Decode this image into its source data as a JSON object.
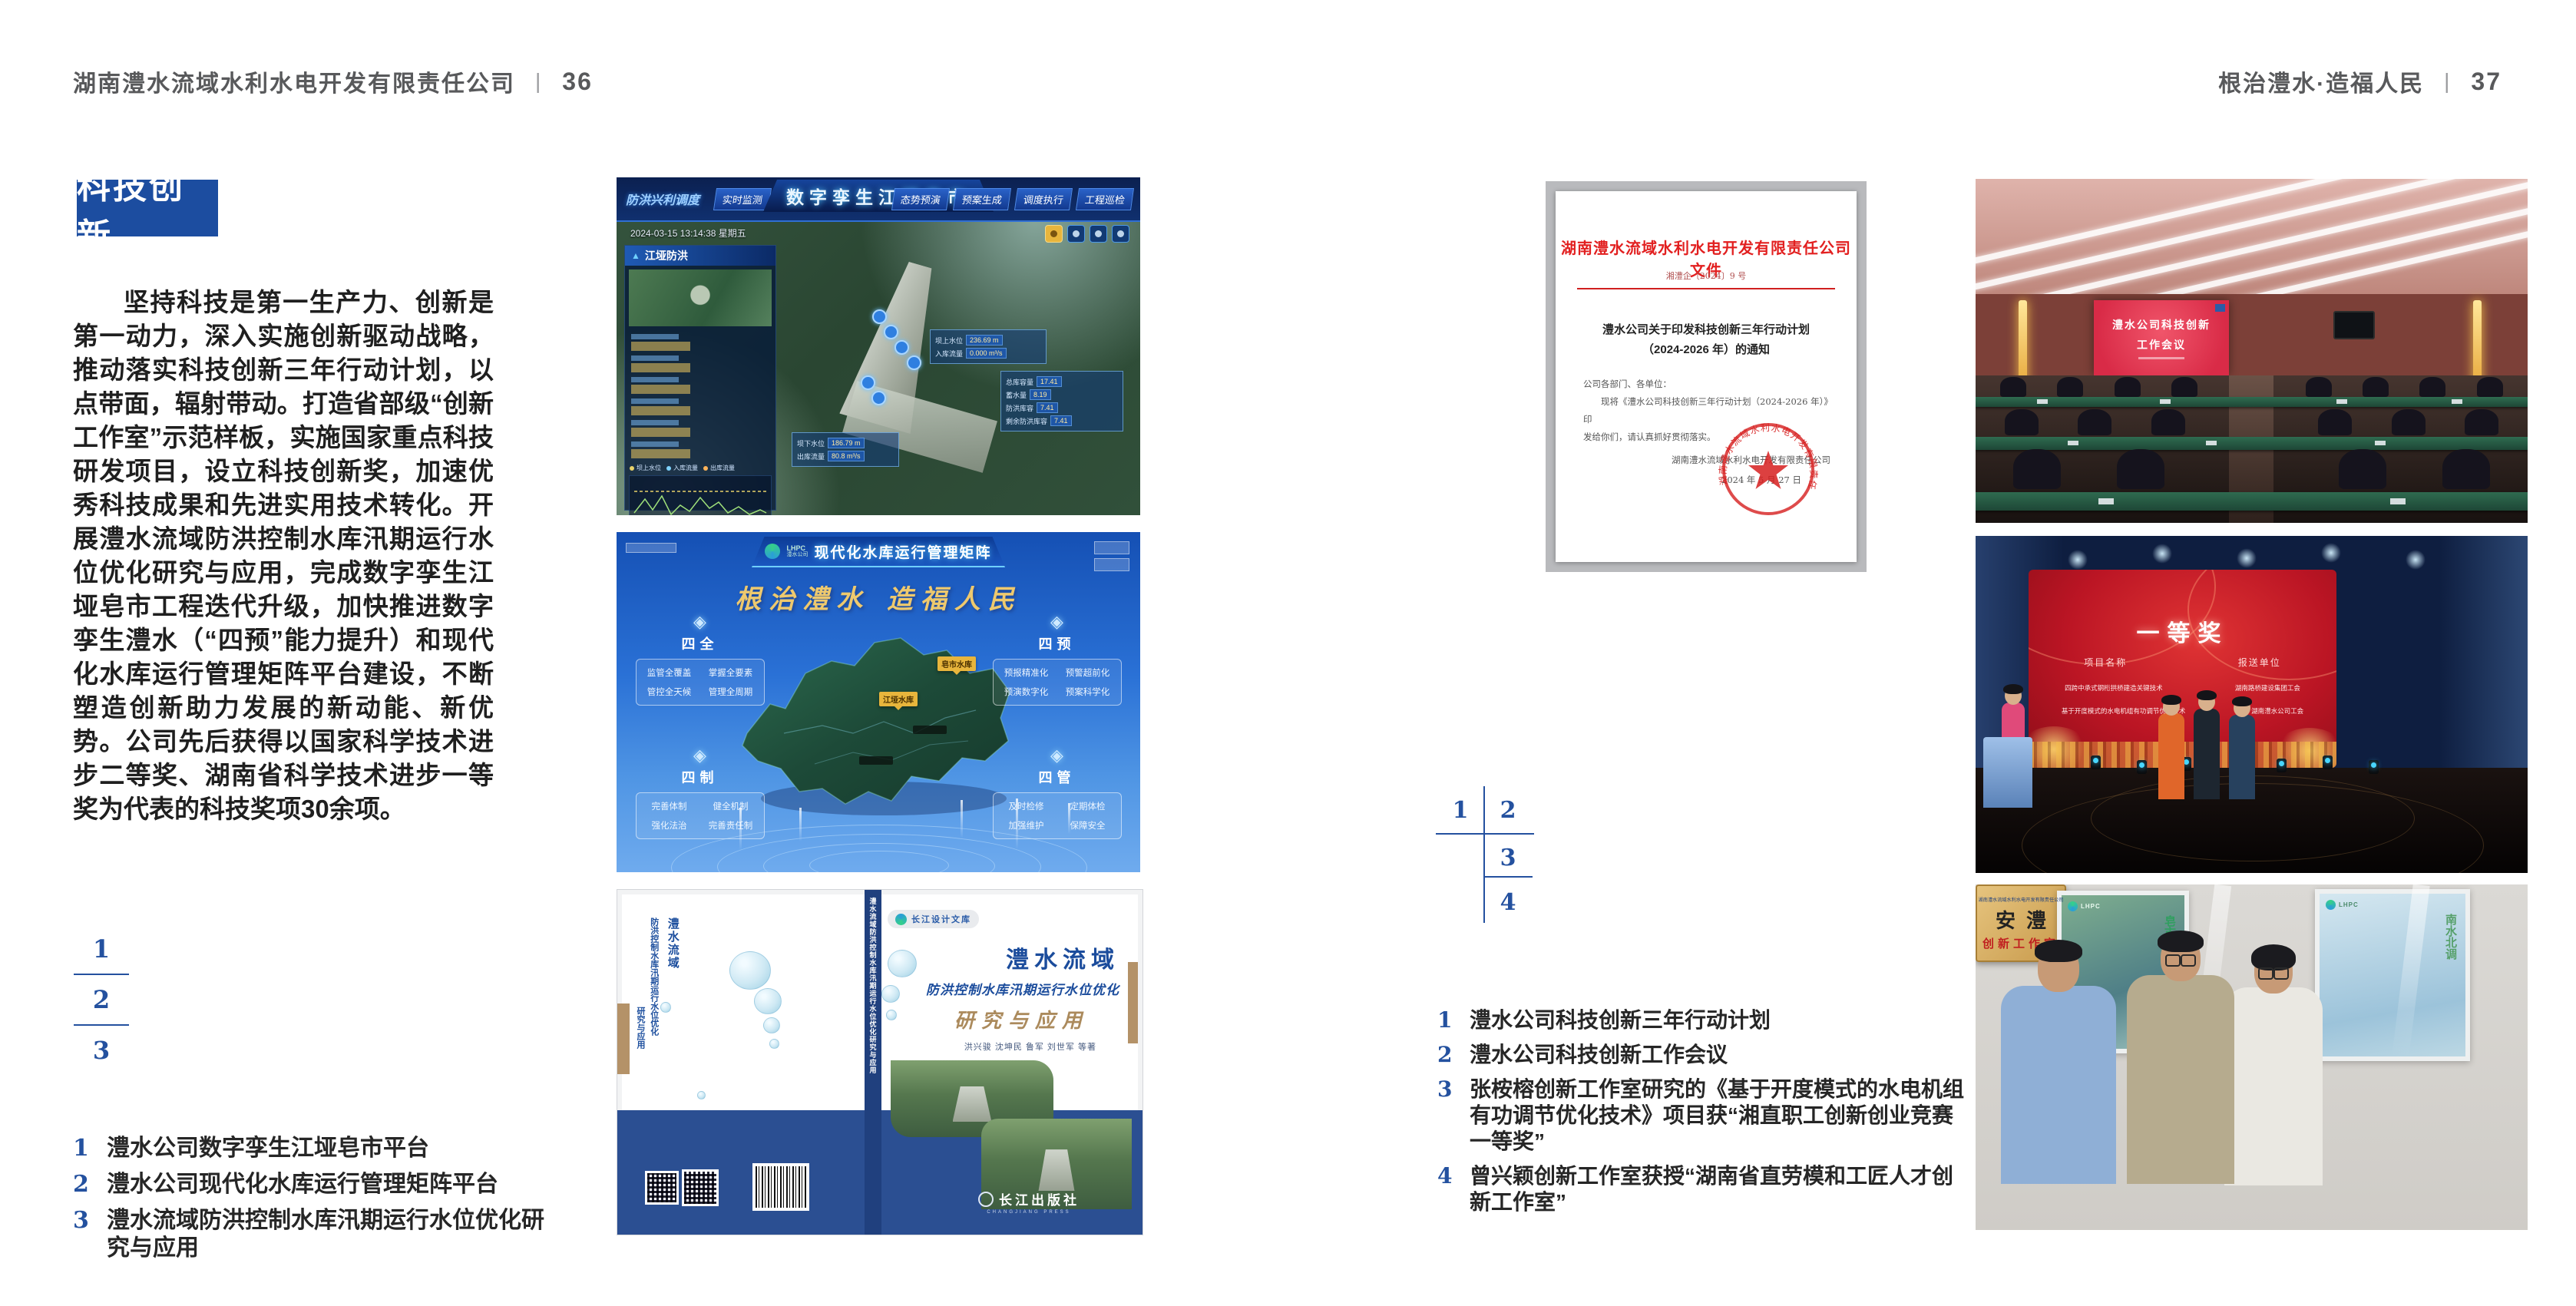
{
  "colors": {
    "accent_blue": "#1c4da0",
    "number_blue": "#24519f",
    "seal_red": "#d02020",
    "band_blue": "#2b4f92",
    "gold": "#eec96e"
  },
  "left_page": {
    "header": {
      "company": "湖南澧水流域水利水电开发有限责任公司",
      "divider": "|",
      "page": "36"
    },
    "badge": "科技创新",
    "paragraph": "坚持科技是第一生产力、创新是第一动力，深入实施创新驱动战略，推动落实科技创新三年行动计划，以点带面，辐射带动。打造省部级“创新工作室”示范样板，实施国家重点科技研发项目，设立科技创新奖，加速优秀科技成果和先进实用技术转化。开展澧水流域防洪控制水库汛期运行水位优化研究与应用，完成数字孪生江垭皂市工程迭代升级，加快推进数字孪生澧水（“四预”能力提升）和现代化水库运行管理矩阵平台建设，不断塑造创新助力发展的新动能、新优势。公司先后获得以国家科学技术进步二等奖、湖南省科学技术进步一等奖为代表的科技奖项30余项。",
    "figure_markers": [
      "1",
      "2",
      "3"
    ],
    "captions": [
      {
        "n": "1",
        "t": "澧水公司数字孪生江垭皂市平台"
      },
      {
        "n": "2",
        "t": "澧水公司现代化水库运行管理矩阵平台"
      },
      {
        "n": "3",
        "t": "澧水流域防洪控制水库汛期运行水位优化研究与应用"
      }
    ]
  },
  "right_page": {
    "header": {
      "slogan": "根治澧水·造福人民",
      "divider": "|",
      "page": "37"
    },
    "figure_markers": [
      "1",
      "2",
      "3",
      "4"
    ],
    "captions": [
      {
        "n": "1",
        "t": "澧水公司科技创新三年行动计划"
      },
      {
        "n": "2",
        "t": "澧水公司科技创新工作会议"
      },
      {
        "n": "3",
        "t": "张桉榕创新工作室研究的《基于开度模式的水电机组有功调节优化技术》项目获“湘直职工创新创业竞赛一等奖”"
      },
      {
        "n": "4",
        "t": "曾兴颖创新工作室获授“湖南省直劳模和工匠人才创新工作室”"
      }
    ]
  },
  "dashboard": {
    "title": "数字孪生江垭皂市",
    "mode_label": "防洪兴利调度",
    "tabs_left": [
      "实时监测",
      "洪水预报",
      "防洪预警"
    ],
    "tabs_right": [
      "态势预演",
      "预案生成",
      "调度执行",
      "工程巡检"
    ],
    "timestamp": "2024-03-15 13:14:38 星期五",
    "panel1_title": "江垭防洪",
    "panel2_title": "江垭发电",
    "legend": [
      "坝上水位",
      "入库流量",
      "出库流量"
    ],
    "tooltip_up": {
      "l1": "坝上水位",
      "v1": "236.69 m",
      "l2": "入库流量",
      "v2": "0.000 m³/s"
    },
    "tooltip_down": {
      "l1": "坝下水位",
      "v1": "186.79 m",
      "l2": "出库流量",
      "v2": "80.8 m³/s"
    },
    "tooltip_side": [
      {
        "label": "总库容量",
        "value": "17.41"
      },
      {
        "label": "蓄水量",
        "value": "8.19"
      },
      {
        "label": "防洪库容",
        "value": "7.41"
      },
      {
        "label": "剩余防洪库容",
        "value": "7.41"
      }
    ]
  },
  "matrix": {
    "logo_line1": "LHPC",
    "logo_line2": "澧水公司",
    "title": "现代化水库运行管理矩阵",
    "slogan": "根治澧水  造福人民",
    "map_labels": [
      "皂市水库",
      "江垭水库"
    ],
    "panels": [
      {
        "title": "四全",
        "items": [
          "监管全覆盖",
          "掌握全要素",
          "管控全天候",
          "管理全周期"
        ]
      },
      {
        "title": "四预",
        "items": [
          "预报精准化",
          "预警超前化",
          "预演数字化",
          "预案科学化"
        ]
      },
      {
        "title": "四制",
        "items": [
          "完善体制",
          "健全机制",
          "强化法治",
          "完善责任制"
        ]
      },
      {
        "title": "四管",
        "items": [
          "及时检修",
          "定期体检",
          "加强维护",
          "保障安全"
        ]
      }
    ]
  },
  "book": {
    "series_badge": "长江设计文库",
    "title_main": "澧水流域",
    "title_sub": "防洪控制水库汛期运行水位优化",
    "title_tail": "研究与应用",
    "authors": "洪兴骏  沈坤民  鲁军  刘世军  等著",
    "publisher": "长江出版社",
    "publisher_en": "CHANGJIANG PRESS",
    "spine_text": "澧水流域防洪控制水库汛期运行水位优化研究与应用"
  },
  "document": {
    "header": "湖南澧水流域水利水电开发有限责任公司文件",
    "doc_no": "湘澧企〔2024〕9 号",
    "title_line1": "澧水公司关于印发科技创新三年行动计划",
    "title_line2": "（2024-2026 年）的通知",
    "salutation": "公司各部门、各单位：",
    "body_line1": "现将《澧水公司科技创新三年行动计划（2024-2026 年）》印",
    "body_line2": "发给你们，请认真抓好贯彻落实。",
    "signature": "湖南澧水流域水利水电开发有限责任公司",
    "date": "2024 年 5 月 27 日",
    "seal_text": "湖南澧水流域水利水电开发有限责任公司"
  },
  "photos": {
    "meeting": {
      "screen_line1": "澧水公司科技创新",
      "screen_line2": "工作会议"
    },
    "award": {
      "title": "一等奖",
      "col1": "项目名称",
      "col2": "报送单位",
      "rows": [
        {
          "project": "四跨中承式钢桁拱桥建造关键技术",
          "org": "湖南路桥建设集团工会"
        },
        {
          "project": "基于开度模式的水电机组有功调节优化技术",
          "org": "湖南澧水公司工会"
        }
      ]
    },
    "group": {
      "plaque_header": "湖南澧水流域水利水电开发有限责任公司",
      "plaque_main": "安澧",
      "plaque_sub": "创新工作室",
      "poster_logo": "LHPC",
      "poster_left": "皂市水库",
      "poster_right": "南水北调"
    }
  }
}
